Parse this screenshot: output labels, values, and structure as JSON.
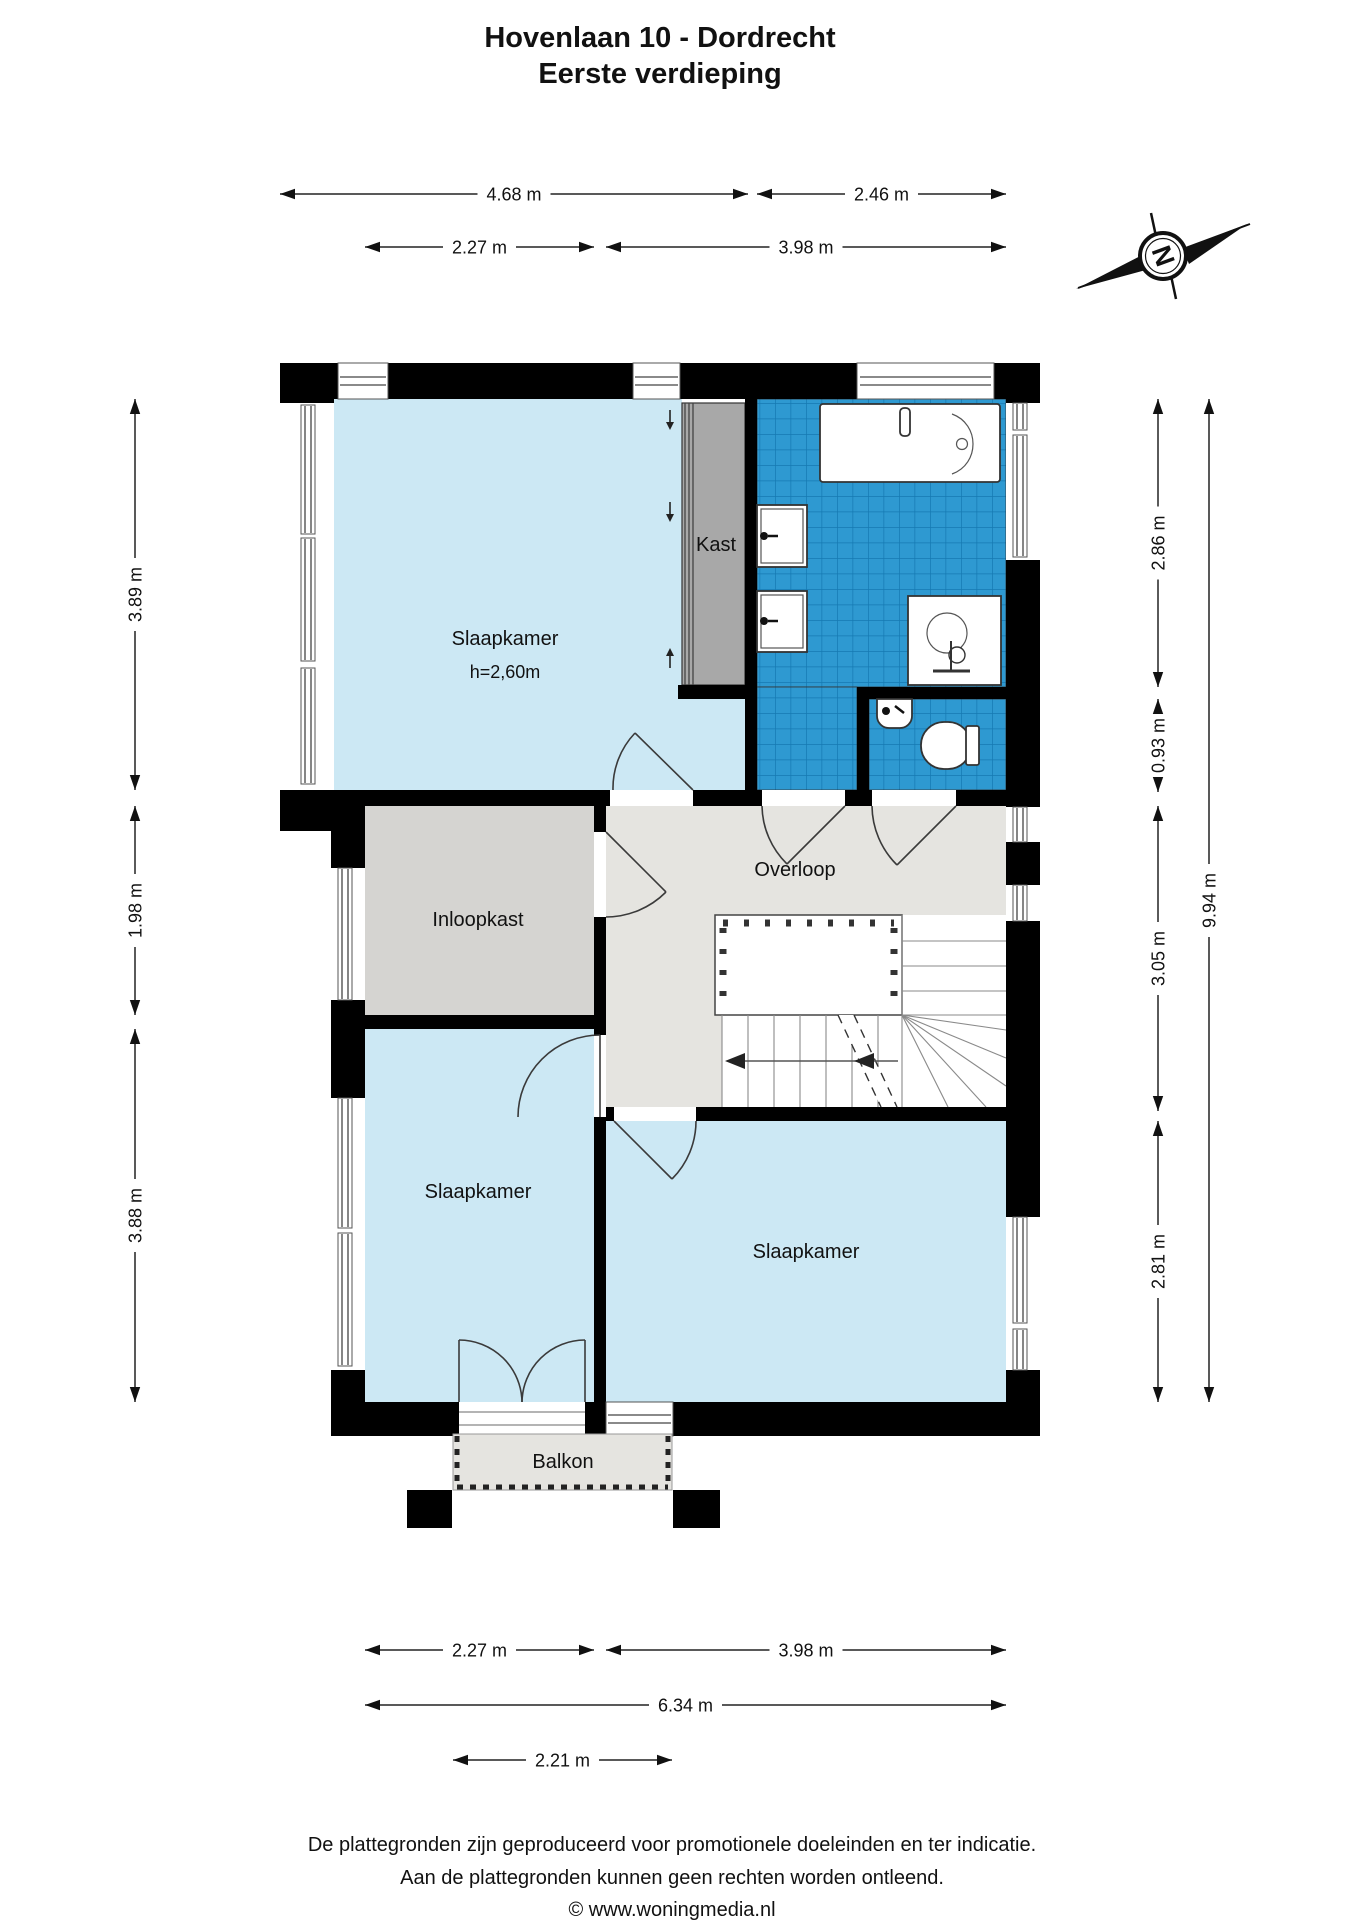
{
  "title": {
    "line1": "Hovenlaan 10 - Dordrecht",
    "line2": "Eerste verdieping"
  },
  "compass": {
    "label": "N"
  },
  "rooms": {
    "bedroom_top": {
      "name": "Slaapkamer",
      "height_note": "h=2,60m"
    },
    "kast": "Kast",
    "overloop": "Overloop",
    "inloopkast": "Inloopkast",
    "bedroom_left": "Slaapkamer",
    "bedroom_right": "Slaapkamer",
    "balkon": "Balkon"
  },
  "dimensions": [
    {
      "id": "t1",
      "label": "4.68 m"
    },
    {
      "id": "t2",
      "label": "2.46 m"
    },
    {
      "id": "t3",
      "label": "2.27 m"
    },
    {
      "id": "t4",
      "label": "3.98 m"
    },
    {
      "id": "l1",
      "label": "3.89 m"
    },
    {
      "id": "l2",
      "label": "1.98 m"
    },
    {
      "id": "l3",
      "label": "3.88 m"
    },
    {
      "id": "r1",
      "label": "2.86 m"
    },
    {
      "id": "r2",
      "label": "0.93 m"
    },
    {
      "id": "r3",
      "label": "3.05 m"
    },
    {
      "id": "r4",
      "label": "2.81 m"
    },
    {
      "id": "r5",
      "label": "9.94 m"
    },
    {
      "id": "b1",
      "label": "2.27 m"
    },
    {
      "id": "b2",
      "label": "3.98 m"
    },
    {
      "id": "b3",
      "label": "6.34 m"
    },
    {
      "id": "b4",
      "label": "2.21 m"
    }
  ],
  "footer": {
    "line1": "De plattegronden zijn geproduceerd voor promotionele doeleinden en ter indicatie.",
    "line2": "Aan de plattegronden kunnen geen rechten worden ontleend.",
    "line3": "© www.woningmedia.nl"
  },
  "colors": {
    "wall": "#000000",
    "room_blue": "#cce8f4",
    "floor_gray": "#e5e4e0",
    "closet_gray": "#d5d4d1",
    "kast_gray": "#a8a8a8",
    "tile_blue": "#2e99d1",
    "tile_grout": "#1579b2"
  }
}
